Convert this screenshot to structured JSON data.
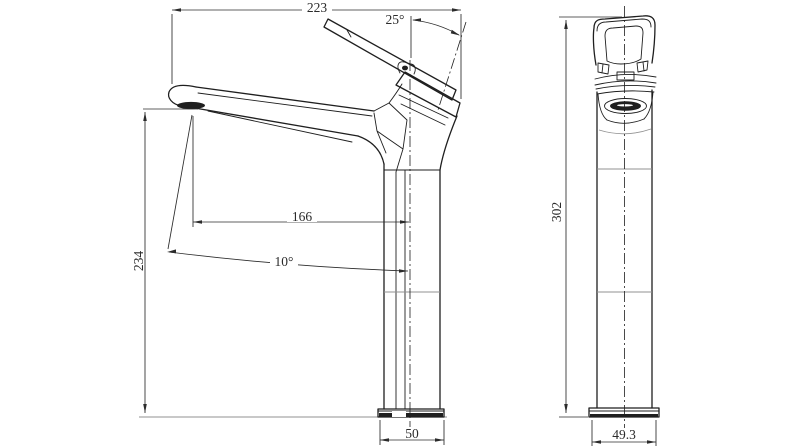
{
  "colors": {
    "bg": "#ffffff",
    "line": "#1f1f1f",
    "dim": "#2b2b2b",
    "light": "#909090"
  },
  "views": {
    "side": {
      "dims": {
        "reach": {
          "value": "223",
          "unit": ""
        },
        "handle_angle": {
          "value": "25",
          "unit": "°"
        },
        "spout_reach": {
          "value": "166",
          "unit": ""
        },
        "spout_angle": {
          "value": "10",
          "unit": "°"
        },
        "height": {
          "value": "234",
          "unit": ""
        },
        "base_width": {
          "value": "50",
          "unit": ""
        }
      }
    },
    "front": {
      "dims": {
        "height": {
          "value": "302",
          "unit": ""
        },
        "base_width": {
          "value": "49.3",
          "unit": ""
        }
      }
    }
  }
}
